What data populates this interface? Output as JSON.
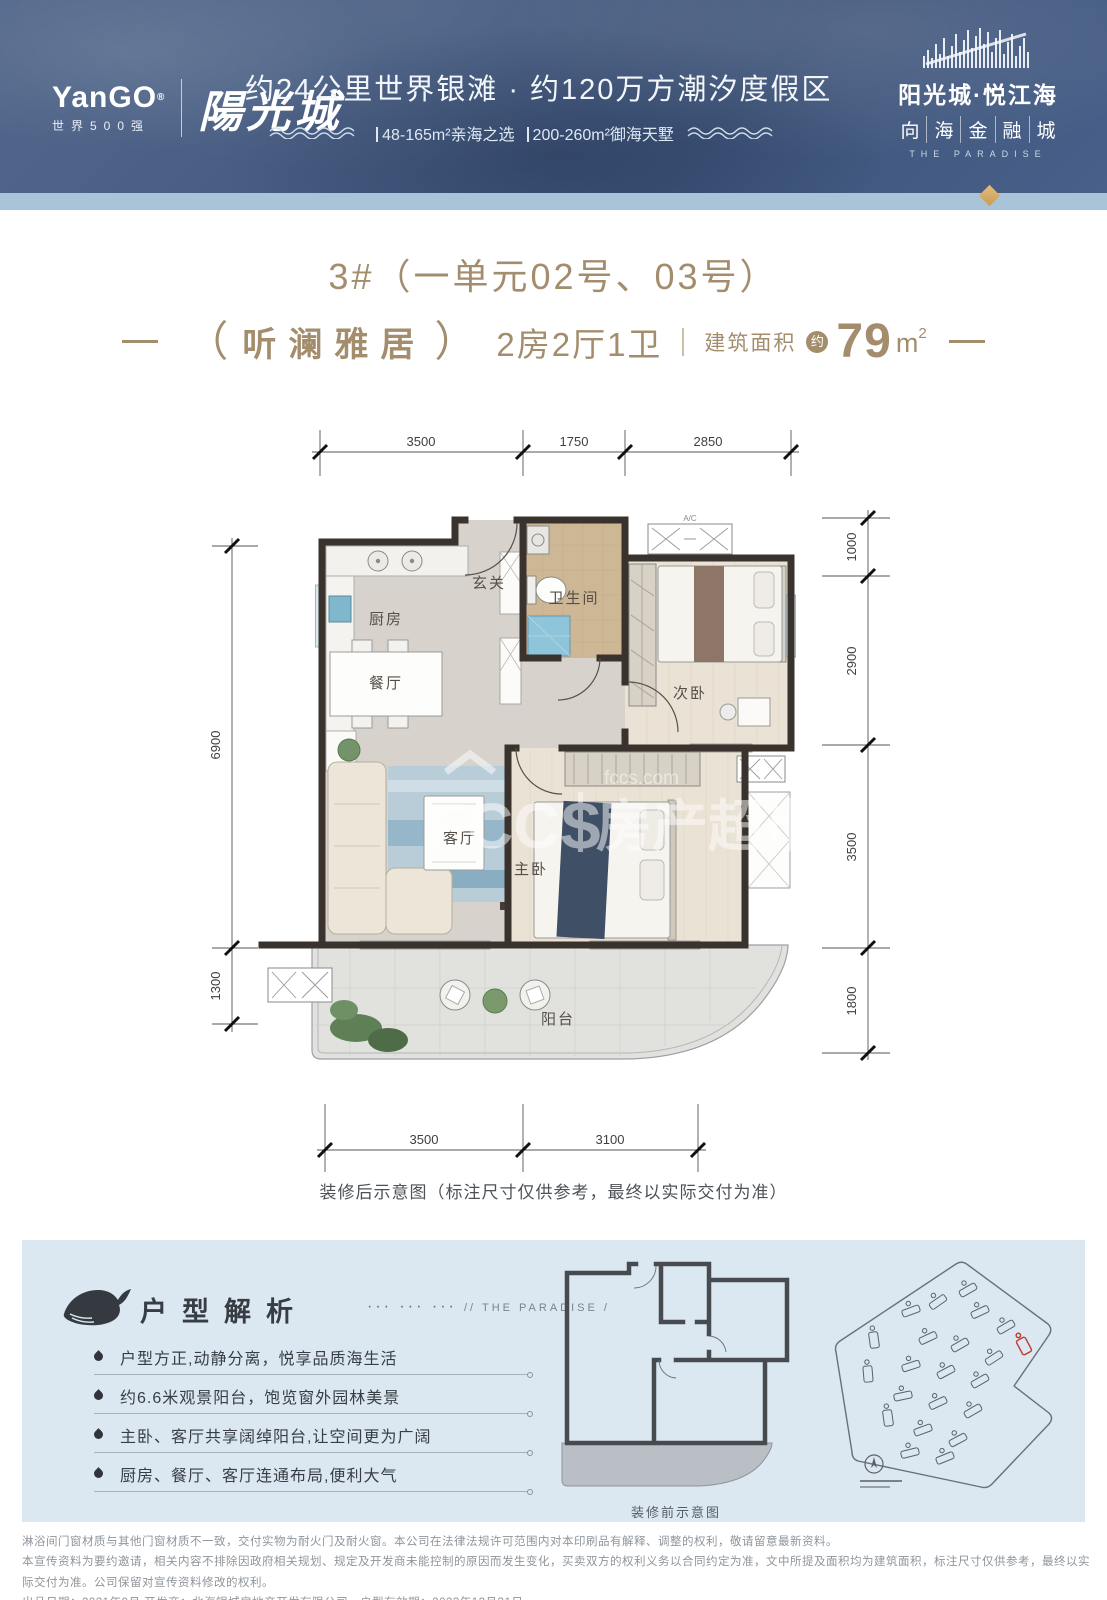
{
  "header": {
    "logo_en": "YanGO",
    "logo_reg": "®",
    "logo_sub": "世界500强",
    "logo_cn": "陽光城",
    "headline": "约24公里世界银滩 · 约120万方潮汐度假区",
    "sub_items": [
      "48-165m²亲海之选",
      "200-260m²御海天墅"
    ],
    "project_name": "阳光城·悦江海",
    "project_sub": [
      "向",
      "海",
      "金",
      "融",
      "城"
    ],
    "project_en": "THE PARADISE"
  },
  "title": {
    "line1": "3#（一单元02号、03号）",
    "paren_open": "（",
    "name": "听澜雅居",
    "paren_close": "）",
    "layout": "2房2厅1卫",
    "area_label": "建筑面积",
    "area_circle": "约",
    "area_value": "79",
    "area_unit_m": "m",
    "area_unit_sup": "2"
  },
  "floorplan": {
    "dims_top": [
      "3500",
      "1750",
      "2850"
    ],
    "dims_left": [
      "6900",
      "1300"
    ],
    "dims_right": [
      "1000",
      "2900",
      "3500",
      "1800"
    ],
    "dims_bottom": [
      "3500",
      "3100"
    ],
    "rooms": {
      "foyer": "玄关",
      "kitchen": "厨房",
      "bath": "卫生间",
      "bed2": "次卧",
      "dining": "餐厅",
      "living": "客厅",
      "master": "主卧",
      "balcony": "阳台"
    },
    "ac_label": "A/C",
    "watermark": {
      "brand": "FCCS",
      "cn": "房产超市",
      "site": "fccs.com"
    },
    "caption": "装修后示意图（标注尺寸仅供参考，最终以实际交付为准）"
  },
  "analysis": {
    "title": "户型解析",
    "dots": "···  ···  ···",
    "en_tag": "//  THE PARADISE  /",
    "points": [
      "户型方正,动静分离，悦享品质海生活",
      "约6.6米观景阳台，饱览窗外园林美景",
      "主卧、客厅共享阔绰阳台,让空间更为广阔",
      "厨房、餐厅、客厅连通布局,便利大气"
    ],
    "mini_caption": "装修前示意图"
  },
  "footer": {
    "line1": "淋浴间门窗材质与其他门窗材质不一致，交付实物为耐火门及耐火窗。本公司在法律法规许可范围内对本印刷品有解释、调整的权利，敬请留意最新资料。",
    "line2": "本宣传资料为要约邀请，相关内容不排除因政府相关规划、规定及开发商未能控制的原因而发生变化，买卖双方的权利义务以合同约定为准，文中所提及面积均为建筑面积，标注尺寸仅供参考，最终以实际交付为准。公司保留对宣传资料修改的权利。",
    "line3": "出品日期：2021年9月  开发商：北海银城房地产开发有限公司。户型有效期：2023年12月31日"
  }
}
